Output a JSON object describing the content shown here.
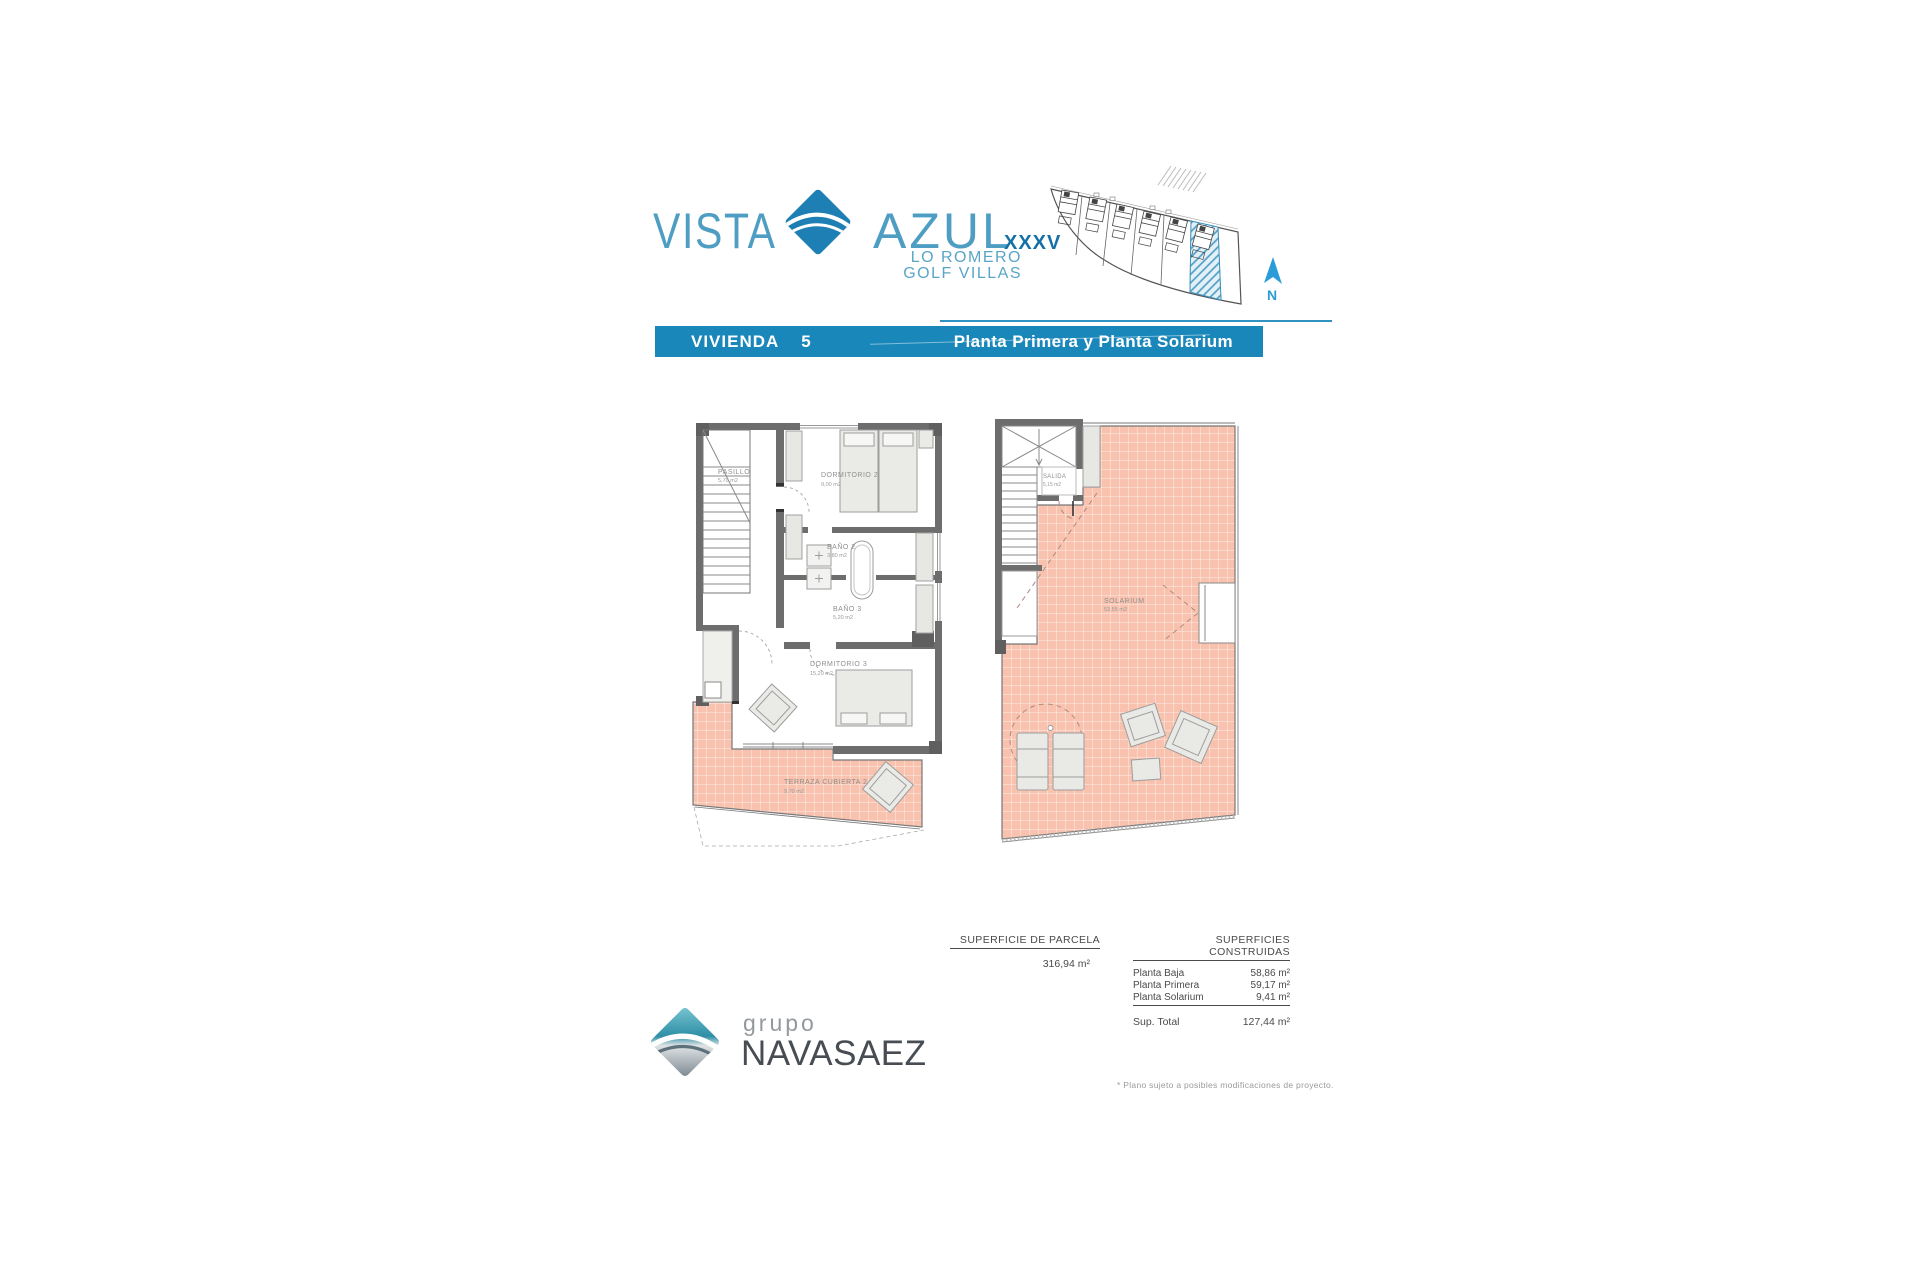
{
  "brand": {
    "vista": "VISTA",
    "azul": "AZUL",
    "roman": "XXXV",
    "sub1": "LO ROMERO",
    "sub2": "GOLF VILLAS",
    "accent_blue": "#1a87ba",
    "logo_blue": "#1d7fb4"
  },
  "title_bar": {
    "label": "VIVIENDA",
    "number": "5",
    "right": "Planta Primera y Planta Solarium"
  },
  "site_plan": {
    "north": "N",
    "highlighted_plot": "5"
  },
  "plans": {
    "primera": {
      "rooms": [
        {
          "name": "PASILLO",
          "area": "5,70 m2"
        },
        {
          "name": "DORMITORIO 2",
          "area": "9,00 m2"
        },
        {
          "name": "BAÑO 2",
          "area": "3,80 m2"
        },
        {
          "name": "BAÑO 3",
          "area": "5,20 m2"
        },
        {
          "name": "DORMITORIO 3",
          "area": "15,20 m2"
        },
        {
          "name": "TERRAZA CUBIERTA 2",
          "area": "9,70 m2"
        }
      ]
    },
    "solarium": {
      "rooms": [
        {
          "name": "SALIDA",
          "area": "5,15 m2"
        },
        {
          "name": "SOLARIUM",
          "area": "53,55 m2"
        }
      ]
    },
    "tile_color": "#f8c2ae"
  },
  "table": {
    "parcela_header": "SUPERFICIE DE PARCELA",
    "parcela_value": "316,94 m²",
    "construidas_header": "SUPERFICIES CONSTRUIDAS",
    "rows": [
      {
        "label": "Planta Baja",
        "value": "58,86 m²"
      },
      {
        "label": "Planta Primera",
        "value": "59,17 m²"
      },
      {
        "label": "Planta Solarium",
        "value": "9,41 m²"
      }
    ],
    "total_label": "Sup. Total",
    "total_value": "127,44 m²"
  },
  "footer": {
    "grupo": "grupo",
    "name": "NAVASAEZ",
    "disclaimer": "* Plano sujeto a posibles modificaciones de proyecto."
  }
}
